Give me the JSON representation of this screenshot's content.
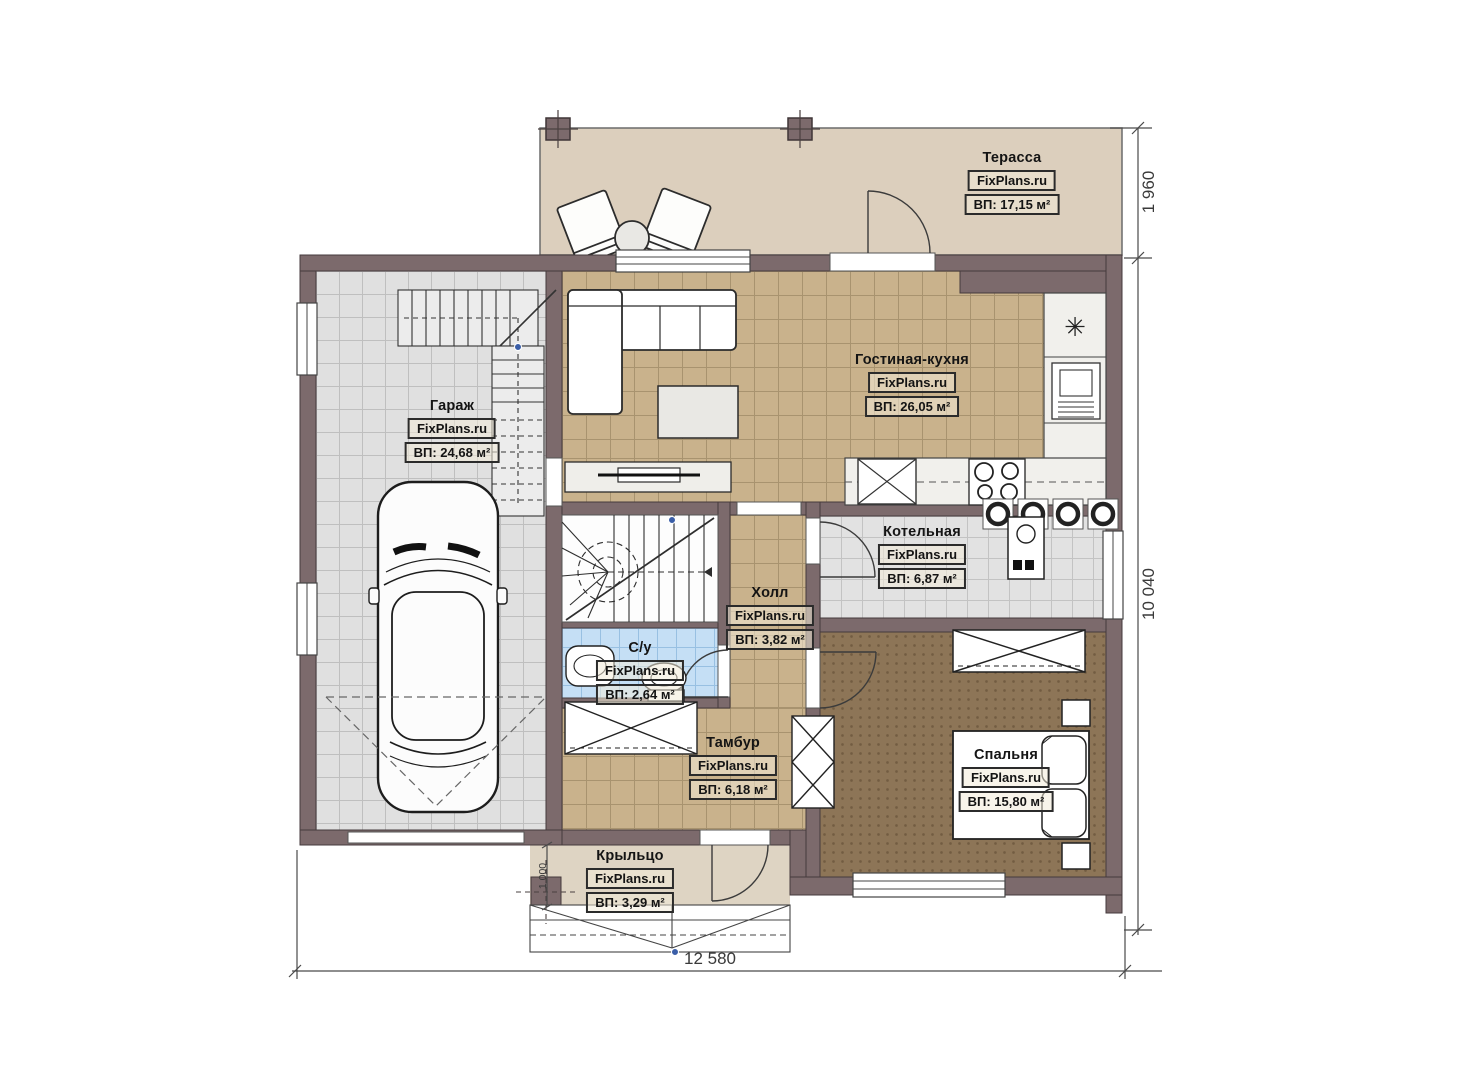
{
  "site": "FixPlans.ru",
  "rooms": {
    "terrace": {
      "name": "Терасса",
      "watermark": "FixPlans.ru",
      "area": "ВП: 17,15 м²"
    },
    "garage": {
      "name": "Гараж",
      "watermark": "FixPlans.ru",
      "area": "ВП: 24,68 м²"
    },
    "living_kitchen": {
      "name": "Гостиная-кухня",
      "watermark": "FixPlans.ru",
      "area": "ВП: 26,05 м²"
    },
    "boiler_room": {
      "name": "Котельная",
      "watermark": "FixPlans.ru",
      "area": "ВП: 6,87 м²"
    },
    "hall": {
      "name": "Холл",
      "watermark": "FixPlans.ru",
      "area": "ВП: 3,82 м²"
    },
    "bathroom": {
      "name": "С/у",
      "watermark": "FixPlans.ru",
      "area": "ВП: 2,64 м²"
    },
    "vestibule": {
      "name": "Тамбур",
      "watermark": "FixPlans.ru",
      "area": "ВП: 6,18 м²"
    },
    "bedroom": {
      "name": "Спальня",
      "watermark": "FixPlans.ru",
      "area": "ВП: 15,80 м²"
    },
    "porch": {
      "name": "Крыльцо",
      "watermark": "FixPlans.ru",
      "area": "ВП: 3,29 м²"
    }
  },
  "dimensions": {
    "terrace_depth": "1 960",
    "house_depth": "10 040",
    "house_width": "12 580",
    "porch_side": "1 000"
  },
  "icons": {
    "fridge_symbol": "✳"
  },
  "colors": {
    "wall": "#7c6a6c",
    "terrace_floor": "#dccfbd",
    "tile_tan": "#c9b28c",
    "tile_gray": "#e0e0e0",
    "tile_blue": "#c5dff5",
    "bedroom_floor": "#8d7557",
    "porch_floor": "#ded4c3"
  }
}
